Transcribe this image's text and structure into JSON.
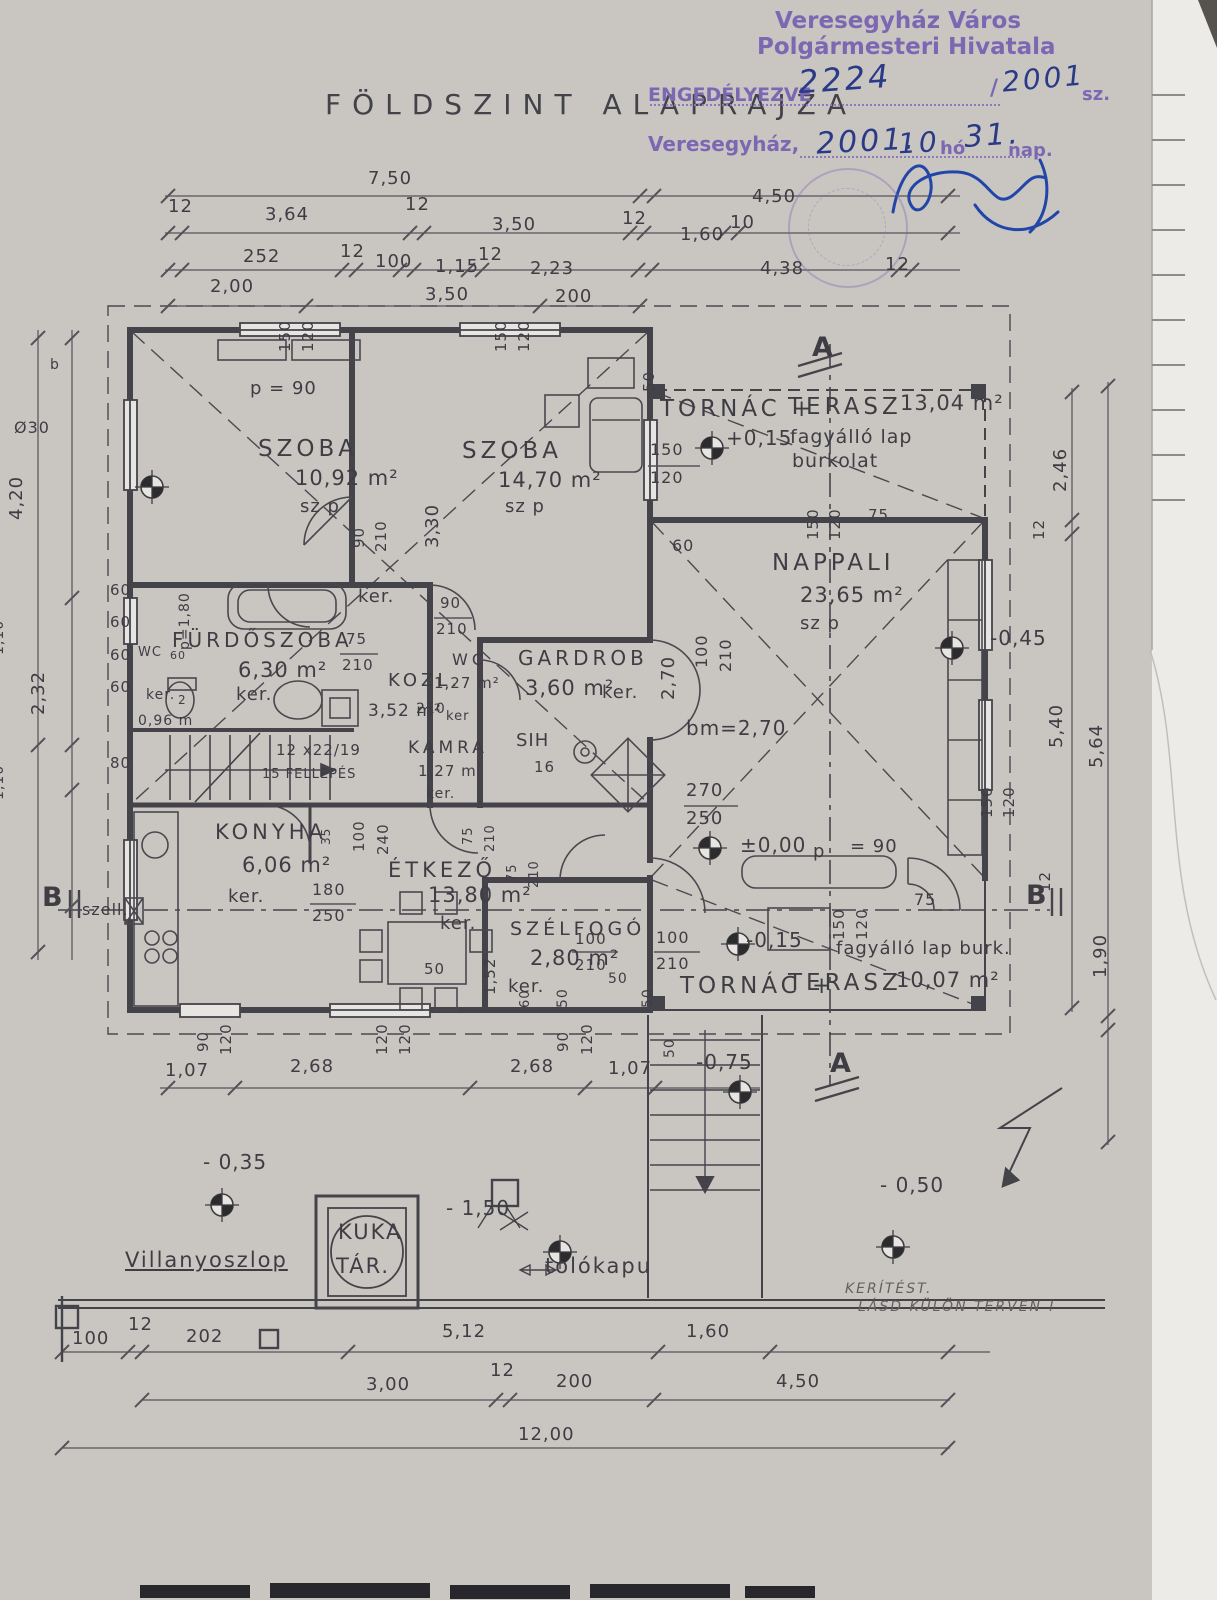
{
  "title": "FÖLDSZINT ALAPRAJZA",
  "stamp": {
    "office_line1": "Veresegyház Város",
    "office_line2": "Polgármesteri Hivatala",
    "permit_label": "ENGEDÉLYEZVE",
    "permit_number": "2224",
    "permit_slash": "/",
    "permit_year": "2001",
    "permit_suffix": "sz.",
    "place": "Veresegyház,",
    "date_year": "2001.",
    "date_month": "10.",
    "month_word": "hó",
    "date_day": "31.",
    "day_word": "nap."
  },
  "plan": {
    "room_labels": [
      {
        "t": "SZOBA",
        "x": 258,
        "y": 438
      },
      {
        "t": "SZOBA",
        "x": 462,
        "y": 440
      },
      {
        "t": "TORNÁC +",
        "x": 660,
        "y": 398
      },
      {
        "t": "TERASZ",
        "x": 788,
        "y": 396
      },
      {
        "t": "NAPPALI",
        "x": 772,
        "y": 552
      },
      {
        "t": "FÜRDŐSZOBA",
        "x": 172,
        "y": 630,
        "fs": 20
      },
      {
        "t": "KOZL.",
        "x": 388,
        "y": 672,
        "fs": 18
      },
      {
        "t": "WC",
        "x": 452,
        "y": 652,
        "fs": 16
      },
      {
        "t": "GARDROB",
        "x": 518,
        "y": 648,
        "fs": 20
      },
      {
        "t": "KAMRA",
        "x": 408,
        "y": 740,
        "fs": 17
      },
      {
        "t": "KONYHA",
        "x": 215,
        "y": 822,
        "fs": 21
      },
      {
        "t": "ÉTKEZŐ",
        "x": 388,
        "y": 860,
        "fs": 21
      },
      {
        "t": "SZÉLFOGÓ",
        "x": 510,
        "y": 920,
        "fs": 19
      },
      {
        "t": "TORNÁC +",
        "x": 680,
        "y": 975
      },
      {
        "t": "TERASZ",
        "x": 788,
        "y": 972
      }
    ],
    "area_labels": [
      {
        "t": "10,92 m²",
        "x": 295,
        "y": 468
      },
      {
        "t": "14,70 m²",
        "x": 498,
        "y": 470
      },
      {
        "t": "13,04 m²",
        "x": 900,
        "y": 393
      },
      {
        "t": "23,65 m²",
        "x": 800,
        "y": 585
      },
      {
        "t": "6,30 m²",
        "x": 238,
        "y": 660
      },
      {
        "t": "3,52 m²",
        "x": 368,
        "y": 703,
        "fs": 17
      },
      {
        "t": "1,27 m²",
        "x": 434,
        "y": 676,
        "fs": 15
      },
      {
        "t": "3,60 m²",
        "x": 525,
        "y": 678
      },
      {
        "t": "1,27 m",
        "x": 418,
        "y": 764,
        "fs": 15
      },
      {
        "t": "6,06 m²",
        "x": 242,
        "y": 855
      },
      {
        "t": "13,80 m²",
        "x": 428,
        "y": 885
      },
      {
        "t": "2,80 m²",
        "x": 530,
        "y": 948
      },
      {
        "t": "10,07 m²",
        "x": 896,
        "y": 970
      }
    ],
    "note_labels": [
      {
        "t": "sz p",
        "x": 300,
        "y": 498
      },
      {
        "t": "sz p",
        "x": 505,
        "y": 498
      },
      {
        "t": "sz p",
        "x": 800,
        "y": 615
      },
      {
        "t": "fagyálló lap",
        "x": 790,
        "y": 428,
        "fs": 19
      },
      {
        "t": "burkolat",
        "x": 792,
        "y": 452,
        "fs": 19
      },
      {
        "t": "fagyálló lap burk.",
        "x": 836,
        "y": 940,
        "fs": 18
      },
      {
        "t": "ker.",
        "x": 358,
        "y": 588
      },
      {
        "t": "ker.",
        "x": 146,
        "y": 688,
        "fs": 14
      },
      {
        "t": "2",
        "x": 178,
        "y": 694,
        "fs": 12
      },
      {
        "t": "0,96 m",
        "x": 138,
        "y": 714,
        "fs": 14
      },
      {
        "t": "ker.",
        "x": 236,
        "y": 686
      },
      {
        "t": "ker.",
        "x": 602,
        "y": 684
      },
      {
        "t": "ker",
        "x": 446,
        "y": 710,
        "fs": 13
      },
      {
        "t": "ker.",
        "x": 426,
        "y": 787,
        "fs": 14
      },
      {
        "t": "ker.",
        "x": 228,
        "y": 888
      },
      {
        "t": "ker.",
        "x": 440,
        "y": 915
      },
      {
        "t": "ker.",
        "x": 508,
        "y": 978
      },
      {
        "t": "bm=2,70",
        "x": 686,
        "y": 718,
        "fs": 20
      },
      {
        "t": "p = 90",
        "x": 250,
        "y": 380
      },
      {
        "t": "p",
        "x": 813,
        "y": 843
      },
      {
        "t": "= 90",
        "x": 850,
        "y": 838
      },
      {
        "t": "12 x22/19",
        "x": 276,
        "y": 743,
        "fs": 15
      },
      {
        "t": "15 FELLÉPÉS",
        "x": 262,
        "y": 768,
        "fs": 13
      },
      {
        "t": "WC",
        "x": 138,
        "y": 646,
        "fs": 13
      },
      {
        "t": "60",
        "x": 170,
        "y": 650,
        "fs": 11
      },
      {
        "t": "p=1,80",
        "x": 178,
        "y": 650,
        "r": -90,
        "fs": 14
      },
      {
        "t": "SIH",
        "x": 516,
        "y": 732,
        "fs": 18
      },
      {
        "t": "16",
        "x": 534,
        "y": 760,
        "fs": 15
      },
      {
        "t": "szell.",
        "x": 82,
        "y": 902,
        "fs": 16
      },
      {
        "t": "Ø30",
        "x": 14,
        "y": 420,
        "fs": 16
      },
      {
        "t": "b",
        "x": 50,
        "y": 358,
        "fs": 14
      }
    ],
    "dim_labels": [
      {
        "t": "7,50",
        "x": 368,
        "y": 170
      },
      {
        "t": "4,50",
        "x": 752,
        "y": 188
      },
      {
        "t": "12",
        "x": 168,
        "y": 198
      },
      {
        "t": "3,64",
        "x": 265,
        "y": 206
      },
      {
        "t": "12",
        "x": 405,
        "y": 196
      },
      {
        "t": "3,50",
        "x": 492,
        "y": 216
      },
      {
        "t": "12",
        "x": 622,
        "y": 210
      },
      {
        "t": "1,60",
        "x": 680,
        "y": 226
      },
      {
        "t": "10",
        "x": 730,
        "y": 214
      },
      {
        "t": "252",
        "x": 243,
        "y": 248
      },
      {
        "t": "12",
        "x": 340,
        "y": 243
      },
      {
        "t": "100",
        "x": 375,
        "y": 253
      },
      {
        "t": "1,15",
        "x": 435,
        "y": 258
      },
      {
        "t": "12",
        "x": 478,
        "y": 246
      },
      {
        "t": "2,23",
        "x": 530,
        "y": 260
      },
      {
        "t": "4,38",
        "x": 760,
        "y": 260
      },
      {
        "t": "12",
        "x": 885,
        "y": 256
      },
      {
        "t": "2,00",
        "x": 210,
        "y": 278
      },
      {
        "t": "3,50",
        "x": 425,
        "y": 286
      },
      {
        "t": "200",
        "x": 555,
        "y": 288
      },
      {
        "t": "4,20",
        "x": 8,
        "y": 520,
        "r": -90
      },
      {
        "t": "1,10",
        "x": -8,
        "y": 655,
        "r": -90,
        "fs": 14
      },
      {
        "t": "2,32",
        "x": 30,
        "y": 715,
        "r": -90
      },
      {
        "t": "1,10",
        "x": -8,
        "y": 800,
        "r": -90,
        "fs": 14
      },
      {
        "t": "60",
        "x": 110,
        "y": 583,
        "fs": 15
      },
      {
        "t": "60",
        "x": 110,
        "y": 615,
        "fs": 15
      },
      {
        "t": "60",
        "x": 110,
        "y": 648,
        "fs": 15
      },
      {
        "t": "60",
        "x": 110,
        "y": 680,
        "fs": 15
      },
      {
        "t": "80",
        "x": 110,
        "y": 756,
        "fs": 15
      },
      {
        "t": "2,46",
        "x": 1052,
        "y": 492,
        "r": -90
      },
      {
        "t": "12",
        "x": 1032,
        "y": 540,
        "r": -90,
        "fs": 15
      },
      {
        "t": "5,40",
        "x": 1048,
        "y": 748,
        "r": -90
      },
      {
        "t": "5,64",
        "x": 1088,
        "y": 768,
        "r": -90
      },
      {
        "t": "12",
        "x": 1038,
        "y": 892,
        "r": -90,
        "fs": 15
      },
      {
        "t": "1,90",
        "x": 1092,
        "y": 978,
        "r": -90
      },
      {
        "t": "1,07",
        "x": 165,
        "y": 1062
      },
      {
        "t": "2,68",
        "x": 290,
        "y": 1058
      },
      {
        "t": "2,68",
        "x": 510,
        "y": 1058
      },
      {
        "t": "1,07",
        "x": 608,
        "y": 1060
      },
      {
        "t": "100",
        "x": 72,
        "y": 1330
      },
      {
        "t": "12",
        "x": 128,
        "y": 1316
      },
      {
        "t": "202",
        "x": 186,
        "y": 1328
      },
      {
        "t": "5,12",
        "x": 442,
        "y": 1323
      },
      {
        "t": "1,60",
        "x": 686,
        "y": 1323
      },
      {
        "t": "3,00",
        "x": 366,
        "y": 1376
      },
      {
        "t": "12",
        "x": 490,
        "y": 1362
      },
      {
        "t": "200",
        "x": 556,
        "y": 1373
      },
      {
        "t": "4,50",
        "x": 776,
        "y": 1373
      },
      {
        "t": "12,00",
        "x": 518,
        "y": 1426
      },
      {
        "t": "150",
        "x": 278,
        "y": 352,
        "r": -90,
        "fs": 15
      },
      {
        "t": "120",
        "x": 301,
        "y": 352,
        "r": -90,
        "fs": 15
      },
      {
        "t": "150",
        "x": 494,
        "y": 352,
        "r": -90,
        "fs": 15
      },
      {
        "t": "120",
        "x": 517,
        "y": 352,
        "r": -90,
        "fs": 15
      },
      {
        "t": "50",
        "x": 642,
        "y": 392,
        "r": -90,
        "fs": 15
      },
      {
        "t": "150",
        "x": 650,
        "y": 442,
        "fs": 16
      },
      {
        "t": "120",
        "x": 650,
        "y": 470,
        "fs": 16
      },
      {
        "t": "90",
        "x": 352,
        "y": 548,
        "r": -90,
        "fs": 15
      },
      {
        "t": "210",
        "x": 374,
        "y": 552,
        "r": -90,
        "fs": 15
      },
      {
        "t": "3,30",
        "x": 424,
        "y": 548,
        "r": -90
      },
      {
        "t": "150",
        "x": 806,
        "y": 540,
        "r": -90,
        "fs": 15
      },
      {
        "t": "120",
        "x": 828,
        "y": 540,
        "r": -90,
        "fs": 15
      },
      {
        "t": "75",
        "x": 868,
        "y": 508,
        "fs": 15
      },
      {
        "t": "60",
        "x": 672,
        "y": 538,
        "fs": 16
      },
      {
        "t": "100",
        "x": 694,
        "y": 668,
        "r": -90,
        "fs": 16
      },
      {
        "t": "210",
        "x": 718,
        "y": 672,
        "r": -90,
        "fs": 16
      },
      {
        "t": "2,70",
        "x": 660,
        "y": 700,
        "r": -90
      },
      {
        "t": "90",
        "x": 440,
        "y": 596,
        "fs": 15
      },
      {
        "t": "210",
        "x": 436,
        "y": 622,
        "fs": 15
      },
      {
        "t": "75",
        "x": 346,
        "y": 632,
        "fs": 15
      },
      {
        "t": "210",
        "x": 342,
        "y": 658,
        "fs": 15
      },
      {
        "t": "210",
        "x": 416,
        "y": 702,
        "fs": 14
      },
      {
        "t": "270",
        "x": 686,
        "y": 782,
        "fs": 18
      },
      {
        "t": "250",
        "x": 686,
        "y": 810,
        "fs": 18
      },
      {
        "t": "150",
        "x": 832,
        "y": 940,
        "r": -90,
        "fs": 15
      },
      {
        "t": "120",
        "x": 855,
        "y": 940,
        "r": -90,
        "fs": 15
      },
      {
        "t": "75",
        "x": 914,
        "y": 892,
        "fs": 16
      },
      {
        "t": "100",
        "x": 656,
        "y": 930,
        "fs": 16
      },
      {
        "t": "210",
        "x": 656,
        "y": 956,
        "fs": 16
      },
      {
        "t": "100",
        "x": 352,
        "y": 852,
        "r": -90,
        "fs": 15
      },
      {
        "t": "240",
        "x": 376,
        "y": 855,
        "r": -90,
        "fs": 15
      },
      {
        "t": "35",
        "x": 320,
        "y": 845,
        "r": -90,
        "fs": 12
      },
      {
        "t": "75",
        "x": 462,
        "y": 845,
        "r": -90,
        "fs": 13
      },
      {
        "t": "210",
        "x": 484,
        "y": 852,
        "r": -90,
        "fs": 13
      },
      {
        "t": "75",
        "x": 506,
        "y": 882,
        "r": -90,
        "fs": 13
      },
      {
        "t": "210",
        "x": 528,
        "y": 888,
        "r": -90,
        "fs": 13
      },
      {
        "t": "180",
        "x": 312,
        "y": 882,
        "fs": 16
      },
      {
        "t": "250",
        "x": 312,
        "y": 908,
        "fs": 16
      },
      {
        "t": "1,52",
        "x": 483,
        "y": 995,
        "r": -90,
        "fs": 15
      },
      {
        "t": "100",
        "x": 575,
        "y": 932,
        "fs": 15
      },
      {
        "t": "210",
        "x": 575,
        "y": 958,
        "fs": 15
      },
      {
        "t": "50",
        "x": 424,
        "y": 962,
        "fs": 15
      },
      {
        "t": "50",
        "x": 556,
        "y": 1008,
        "r": -90,
        "fs": 14
      },
      {
        "t": "50",
        "x": 608,
        "y": 972,
        "fs": 14
      },
      {
        "t": "50",
        "x": 641,
        "y": 1008,
        "r": -90,
        "fs": 14
      },
      {
        "t": "60",
        "x": 519,
        "y": 1008,
        "r": -90,
        "fs": 13
      },
      {
        "t": "90",
        "x": 196,
        "y": 1052,
        "r": -90,
        "fs": 15
      },
      {
        "t": "120",
        "x": 219,
        "y": 1055,
        "r": -90,
        "fs": 15
      },
      {
        "t": "120",
        "x": 375,
        "y": 1055,
        "r": -90,
        "fs": 15
      },
      {
        "t": "120",
        "x": 398,
        "y": 1055,
        "r": -90,
        "fs": 15
      },
      {
        "t": "90",
        "x": 556,
        "y": 1052,
        "r": -90,
        "fs": 15
      },
      {
        "t": "120",
        "x": 580,
        "y": 1055,
        "r": -90,
        "fs": 15
      },
      {
        "t": "50",
        "x": 663,
        "y": 1058,
        "r": -90,
        "fs": 14
      },
      {
        "t": "150",
        "x": 980,
        "y": 818,
        "r": -90,
        "fs": 15
      },
      {
        "t": "120",
        "x": 1002,
        "y": 818,
        "r": -90,
        "fs": 15
      }
    ],
    "level_labels": [
      {
        "t": "+0,15",
        "x": 726,
        "y": 428
      },
      {
        "t": "-0,45",
        "x": 990,
        "y": 628
      },
      {
        "t": "±0,00",
        "x": 740,
        "y": 835
      },
      {
        "t": "-0,15",
        "x": 746,
        "y": 930
      },
      {
        "t": "-0,75",
        "x": 696,
        "y": 1052
      },
      {
        "t": "- 0,35",
        "x": 203,
        "y": 1152
      },
      {
        "t": "- 0,50",
        "x": 880,
        "y": 1175
      },
      {
        "t": "- 1,50",
        "x": 446,
        "y": 1198
      }
    ],
    "section_labels": [
      {
        "t": "A",
        "x": 812,
        "y": 334
      },
      {
        "t": "A",
        "x": 830,
        "y": 1050
      },
      {
        "t": "B",
        "x": 42,
        "y": 884
      },
      {
        "t": "B",
        "x": 1026,
        "y": 882
      }
    ],
    "site_labels": [
      {
        "t": "Villanyoszlop",
        "x": 125,
        "y": 1250,
        "u": 1
      },
      {
        "t": "KUKA",
        "x": 338,
        "y": 1222
      },
      {
        "t": "TÁR.",
        "x": 336,
        "y": 1256
      },
      {
        "t": "tolókapu",
        "x": 545,
        "y": 1256
      }
    ],
    "annotation_labels": [
      {
        "t": "KERÍTÉST.",
        "x": 845,
        "y": 1282
      },
      {
        "t": "LÁSD KÜLÖN TERVEN !",
        "x": 858,
        "y": 1300
      }
    ]
  },
  "colors": {
    "ink": "#3e3d43",
    "stamp_purple": "#7c68b2",
    "signature_blue": "#2246a8",
    "paper": "#e7e5e2"
  }
}
